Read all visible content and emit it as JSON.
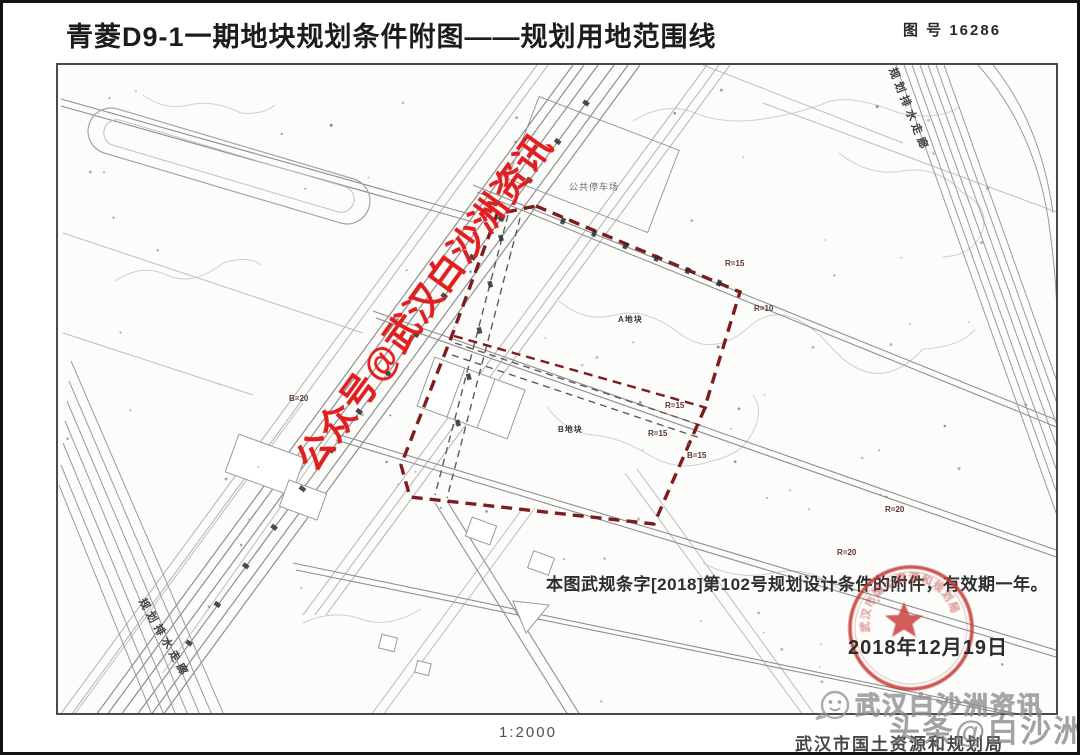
{
  "header": {
    "title": "青菱D9-1一期地块规划条件附图——规划用地范围线",
    "drawing_no_label": "图 号",
    "drawing_no": "16286"
  },
  "map": {
    "watermark": "公众号@武汉白沙洲资讯",
    "parking_label": "公共停车场",
    "plot_a_label": "A地块",
    "plot_b_label": "B地块",
    "corridor_label_ne": "规划排水走廊",
    "corridor_label_sw": "规划排水走廊",
    "radius_labels": [
      {
        "text": "R=15"
      },
      {
        "text": "R=10"
      },
      {
        "text": "R=15"
      },
      {
        "text": "R=15"
      },
      {
        "text": "B=15"
      },
      {
        "text": "R=20"
      },
      {
        "text": "R=20"
      },
      {
        "text": "B=20"
      }
    ],
    "note": "本图武规条字[2018]第102号规划设计条件的附件，有效期一年。",
    "stamp_date": "2018年12月19日",
    "seal_text": "武汉市国土资源和规划局"
  },
  "footer": {
    "scale": "1:2000",
    "agency": "武汉市国土资源和规划局",
    "watermark_main": "头条@白沙洲",
    "watermark_brand": "武汉白沙洲资讯"
  },
  "colors": {
    "watermark_red": "#e01f1f",
    "boundary_red": "#7a1e1e",
    "seal_red": "#c03a3a"
  }
}
